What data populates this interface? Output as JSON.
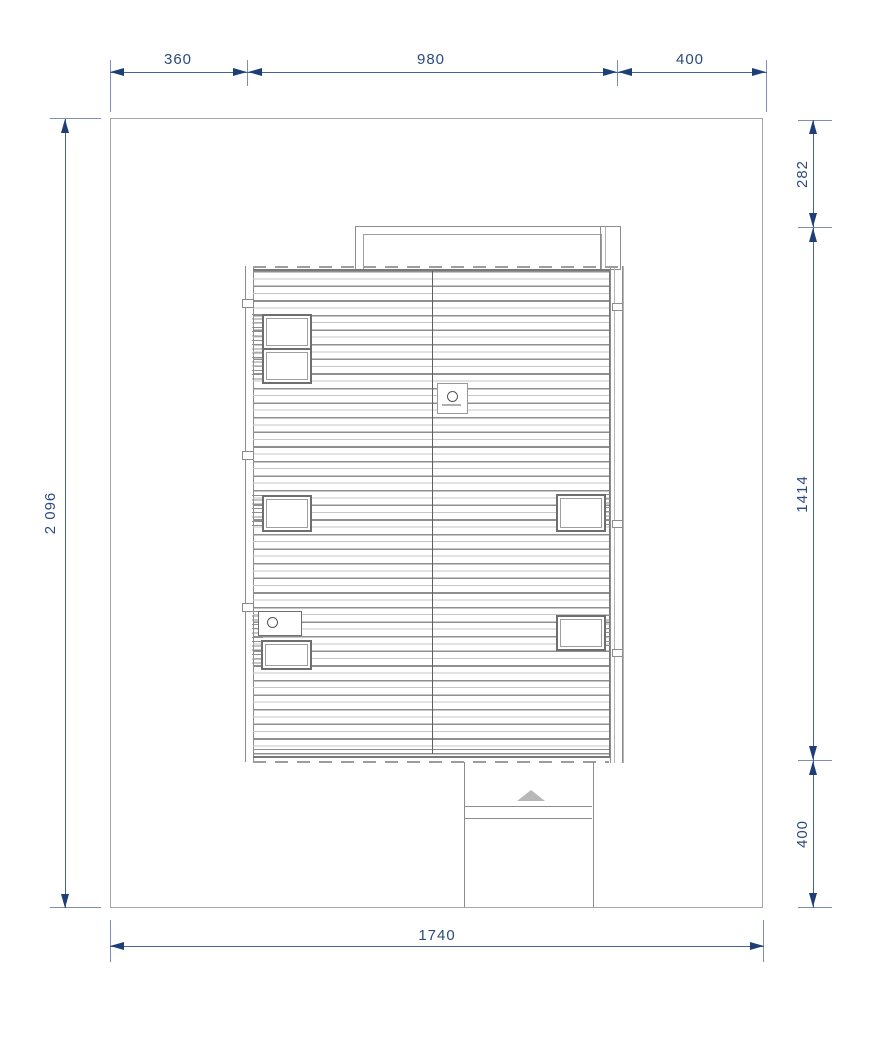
{
  "drawing": {
    "title": "roof-site-plan",
    "type": "architectural plan view of a house roof on a site, with dimension chains",
    "dimensions": {
      "top": {
        "seg1": "360",
        "seg2": "980",
        "seg3": "400"
      },
      "left": {
        "total": "2 096"
      },
      "right": {
        "seg1": "282",
        "seg2": "1414",
        "seg3": "400"
      },
      "bottom": {
        "total": "1740"
      }
    },
    "features": {
      "site_boundary": "property boundary rectangle",
      "roof": "striped gable roof plan with central ridge",
      "terrace": "railing outline at top edge of roof",
      "skylights": [
        "top-left pair",
        "mid-left",
        "mid-right",
        "lower-left",
        "lower-right"
      ],
      "vent": "roof vent box with round outlet",
      "chimney": "chimney box with round flue on ridge",
      "entrance": "entrance walkway with direction triangle below roof"
    },
    "colors": {
      "dimension_line": "#44639c",
      "extension_line": "#7b8fb4",
      "arrow": "#1e3e76",
      "dimension_text": "#2c4a7c",
      "outline_gray": "#8c8c8c",
      "roof_stripe_dark": "#8f8f8f",
      "roof_stripe_light": "#c6c6c6",
      "background": "#ffffff"
    }
  }
}
